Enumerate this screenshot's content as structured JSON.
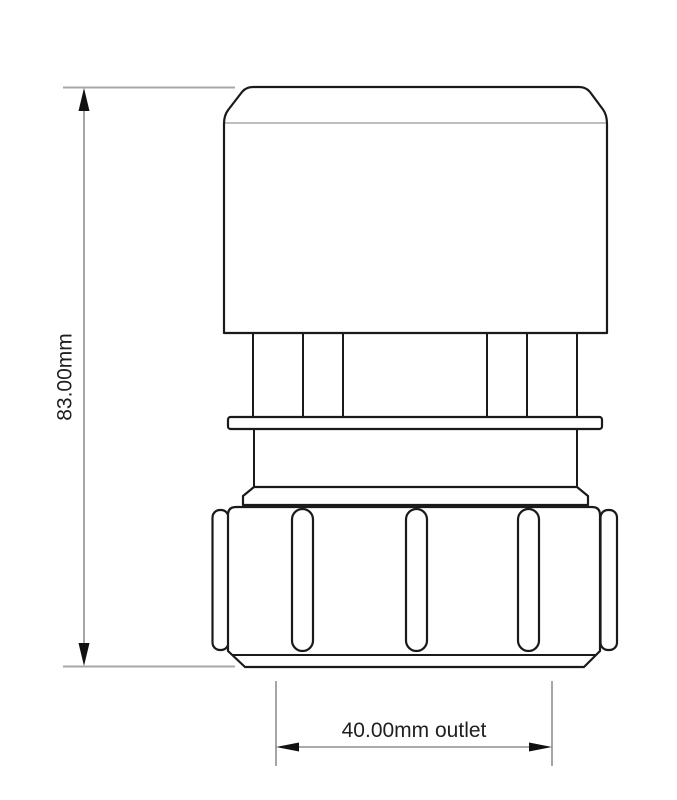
{
  "drawing": {
    "description": "Technical line drawing of an air admittance valve with compression nut outlet",
    "labels": {
      "height": "83.00mm",
      "outlet": "40.00mm outlet"
    },
    "colors": {
      "background": "#ffffff",
      "outline": "#1a1a1a",
      "thin_line": "#7d7d7d",
      "extension_line": "#a8a8a8",
      "dimension_line": "#8f8f8f",
      "arrow": "#111111",
      "text": "#1f1f1f"
    }
  }
}
